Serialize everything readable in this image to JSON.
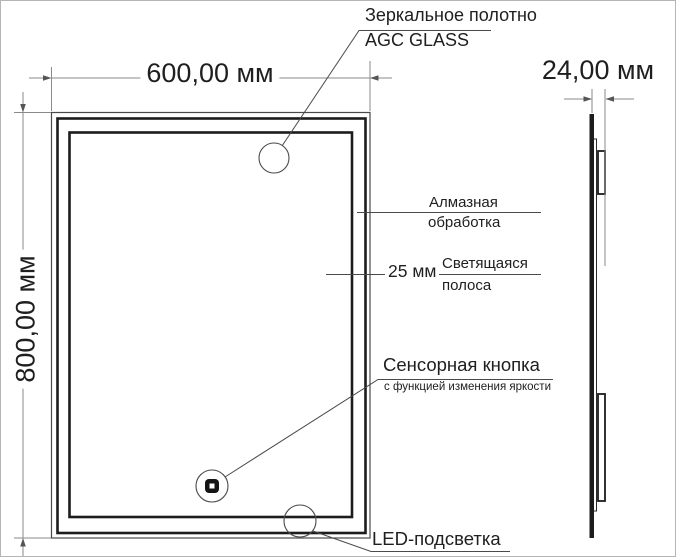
{
  "dimensions": {
    "width": "600,00 мм",
    "height": "800,00 мм",
    "depth": "24,00 мм",
    "strip_width": "25 мм"
  },
  "callouts": {
    "mirror_glass": {
      "line1": "Зеркальное полотно",
      "line2": "AGC GLASS"
    },
    "diamond_edge": {
      "line1": "Алмазная",
      "line2": "обработка"
    },
    "light_strip": {
      "line1": "Светящаяся",
      "line2": "полоса"
    },
    "touch_button": {
      "title": "Сенсорная кнопка",
      "subtitle": "с функцией изменения яркости"
    },
    "led_backlight": {
      "label": "LED-подсветка"
    }
  },
  "colors": {
    "frame_line": "#1c1c1c",
    "thin_line": "#4a4a4a",
    "dimension_line": "#8a8a8a",
    "text": "#1f1f1f",
    "background": "#ffffff"
  }
}
